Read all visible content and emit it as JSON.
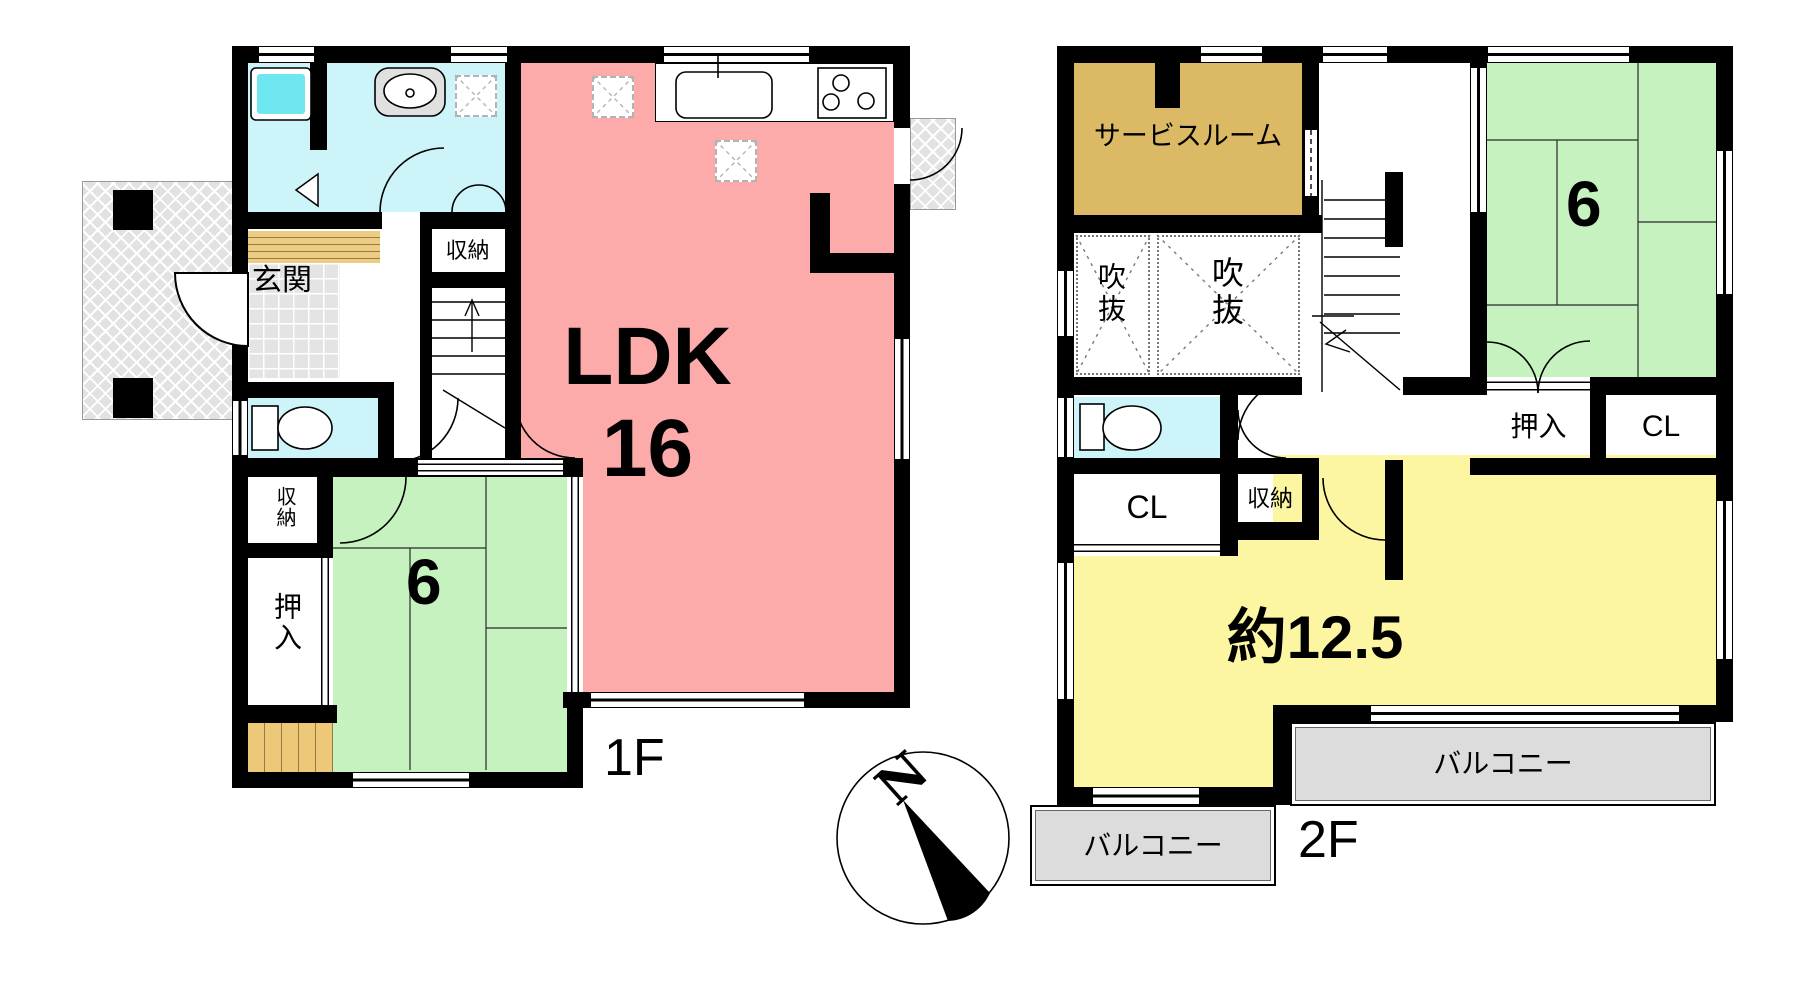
{
  "compass": {
    "north_label": "N"
  },
  "floor1": {
    "floor_label": "1F",
    "rooms": {
      "ldk_label": "LDK",
      "ldk_size": "16",
      "tatami_size": "6",
      "genkan": "玄関",
      "storage_hall": "収納",
      "storage_corner": "収納",
      "oshiire": "押入"
    }
  },
  "floor2": {
    "floor_label": "2F",
    "rooms": {
      "service_room": "サービスルーム",
      "void_left": "吹抜",
      "void_right": "吹抜",
      "tatami_size": "6",
      "oshiire": "押入",
      "closet_right": "CL",
      "closet_left": "CL",
      "storage": "収納",
      "main_room": "約12.5",
      "balcony_left": "バルコニー",
      "balcony_right": "バルコニー"
    }
  },
  "colors": {
    "wall": "#000000",
    "ldk_pink": "#fcaaaa",
    "tatami_green": "#c6f2bf",
    "water_cyan": "#cdf4f8",
    "bathtub_cyan": "#6fe7f1",
    "service_tan": "#dcb964",
    "room_yellow": "#fcf6a2",
    "wood_step": "#eccb82",
    "balcony_gray": "#dcdcdc",
    "terrace_gray": "#e2e2e2"
  }
}
